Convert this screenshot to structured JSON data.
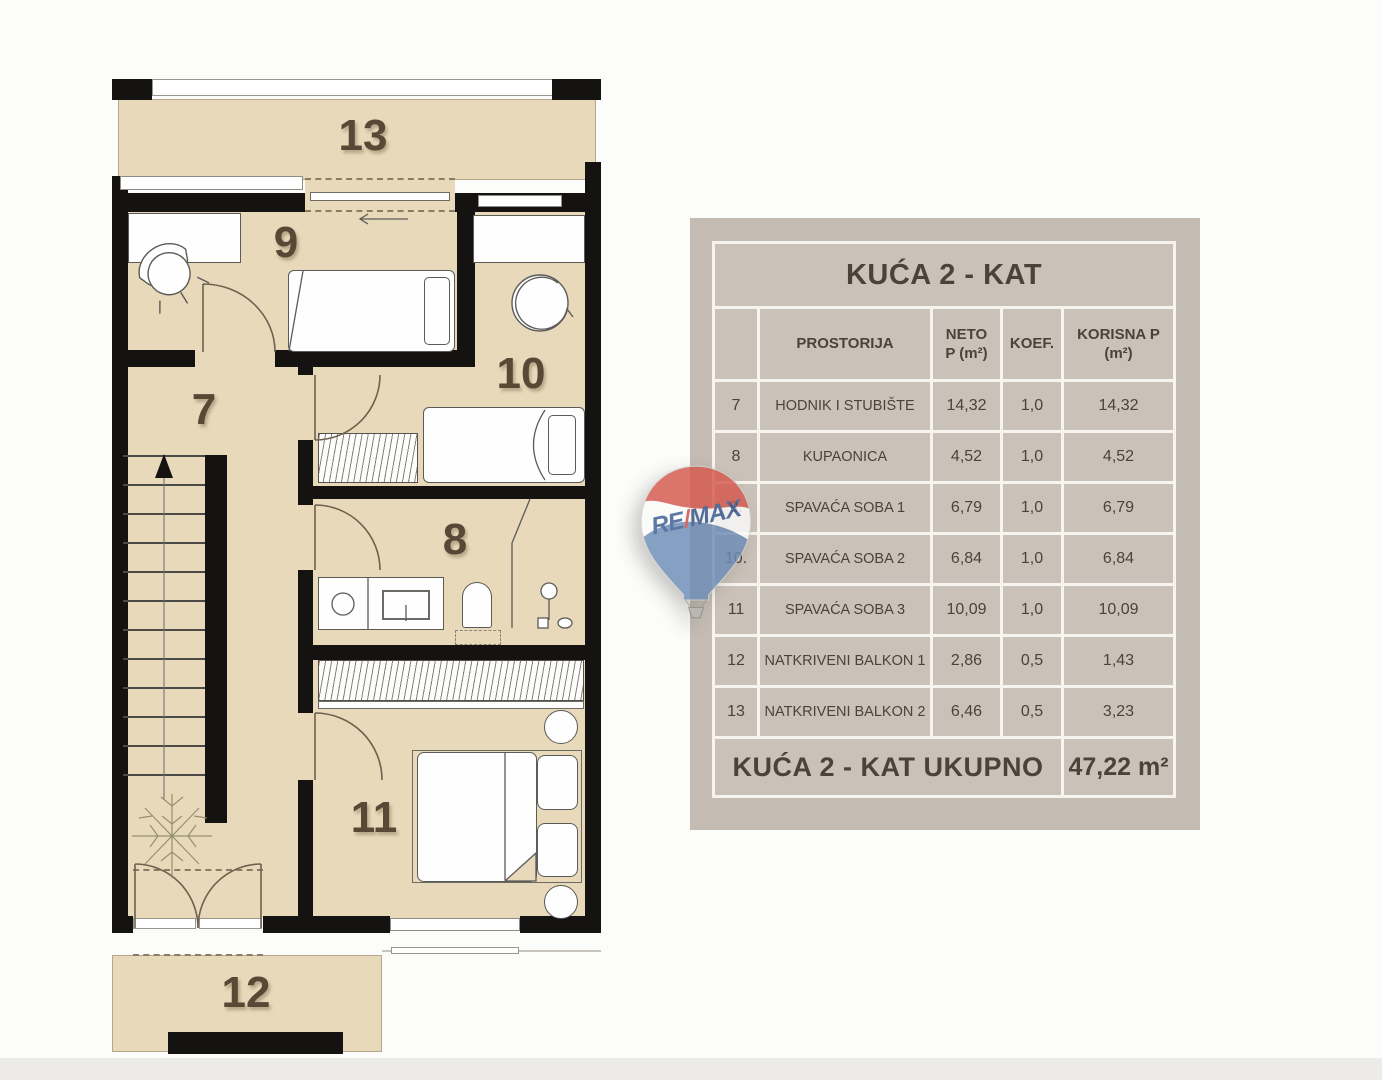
{
  "plan": {
    "labels": {
      "room7": "7",
      "room8": "8",
      "room9": "9",
      "room10": "10",
      "room11": "11",
      "balcony12": "12",
      "balcony13": "13"
    }
  },
  "logo": {
    "re": "RE",
    "slash": "/",
    "max": "MAX"
  },
  "table": {
    "title": "KUĆA 2 - KAT",
    "header": {
      "rooms": "PROSTORIJA",
      "neto_line1": "NETO",
      "neto_line2": "P (m²)",
      "koef": "KOEF.",
      "korisna_line1": "KORISNA P",
      "korisna_line2": "(m²)"
    },
    "rows": [
      {
        "num": "7",
        "name": "HODNIK I STUBIŠTE",
        "neto": "14,32",
        "koef": "1,0",
        "korisna": "14,32"
      },
      {
        "num": "8",
        "name": "KUPAONICA",
        "neto": "4,52",
        "koef": "1,0",
        "korisna": "4,52"
      },
      {
        "num": "9.",
        "name": "SPAVAĆA SOBA 1",
        "neto": "6,79",
        "koef": "1,0",
        "korisna": "6,79"
      },
      {
        "num": "10.",
        "name": "SPAVAĆA SOBA 2",
        "neto": "6,84",
        "koef": "1,0",
        "korisna": "6,84"
      },
      {
        "num": "11",
        "name": "SPAVAĆA SOBA 3",
        "neto": "10,09",
        "koef": "1,0",
        "korisna": "10,09"
      },
      {
        "num": "12",
        "name": "NATKRIVENI BALKON 1",
        "neto": "2,86",
        "koef": "0,5",
        "korisna": "1,43"
      },
      {
        "num": "13",
        "name": "NATKRIVENI BALKON 2",
        "neto": "6,46",
        "koef": "0,5",
        "korisna": "3,23"
      }
    ],
    "footer": {
      "label": "KUĆA 2 - KAT UKUPNO",
      "total": "47,22 m²"
    }
  },
  "colors": {
    "floor_tan": "#e7d9ba",
    "wall_black": "#141311",
    "panel_taupe": "#c4bcb3",
    "cell_taupe": "#cac2b9",
    "grid_line": "#f7f4ef",
    "label_brown": "#5a4836",
    "logo_red": "#d4574c",
    "logo_blue_text": "#3a5b94",
    "logo_blue_fill": "#6c8cb6"
  }
}
